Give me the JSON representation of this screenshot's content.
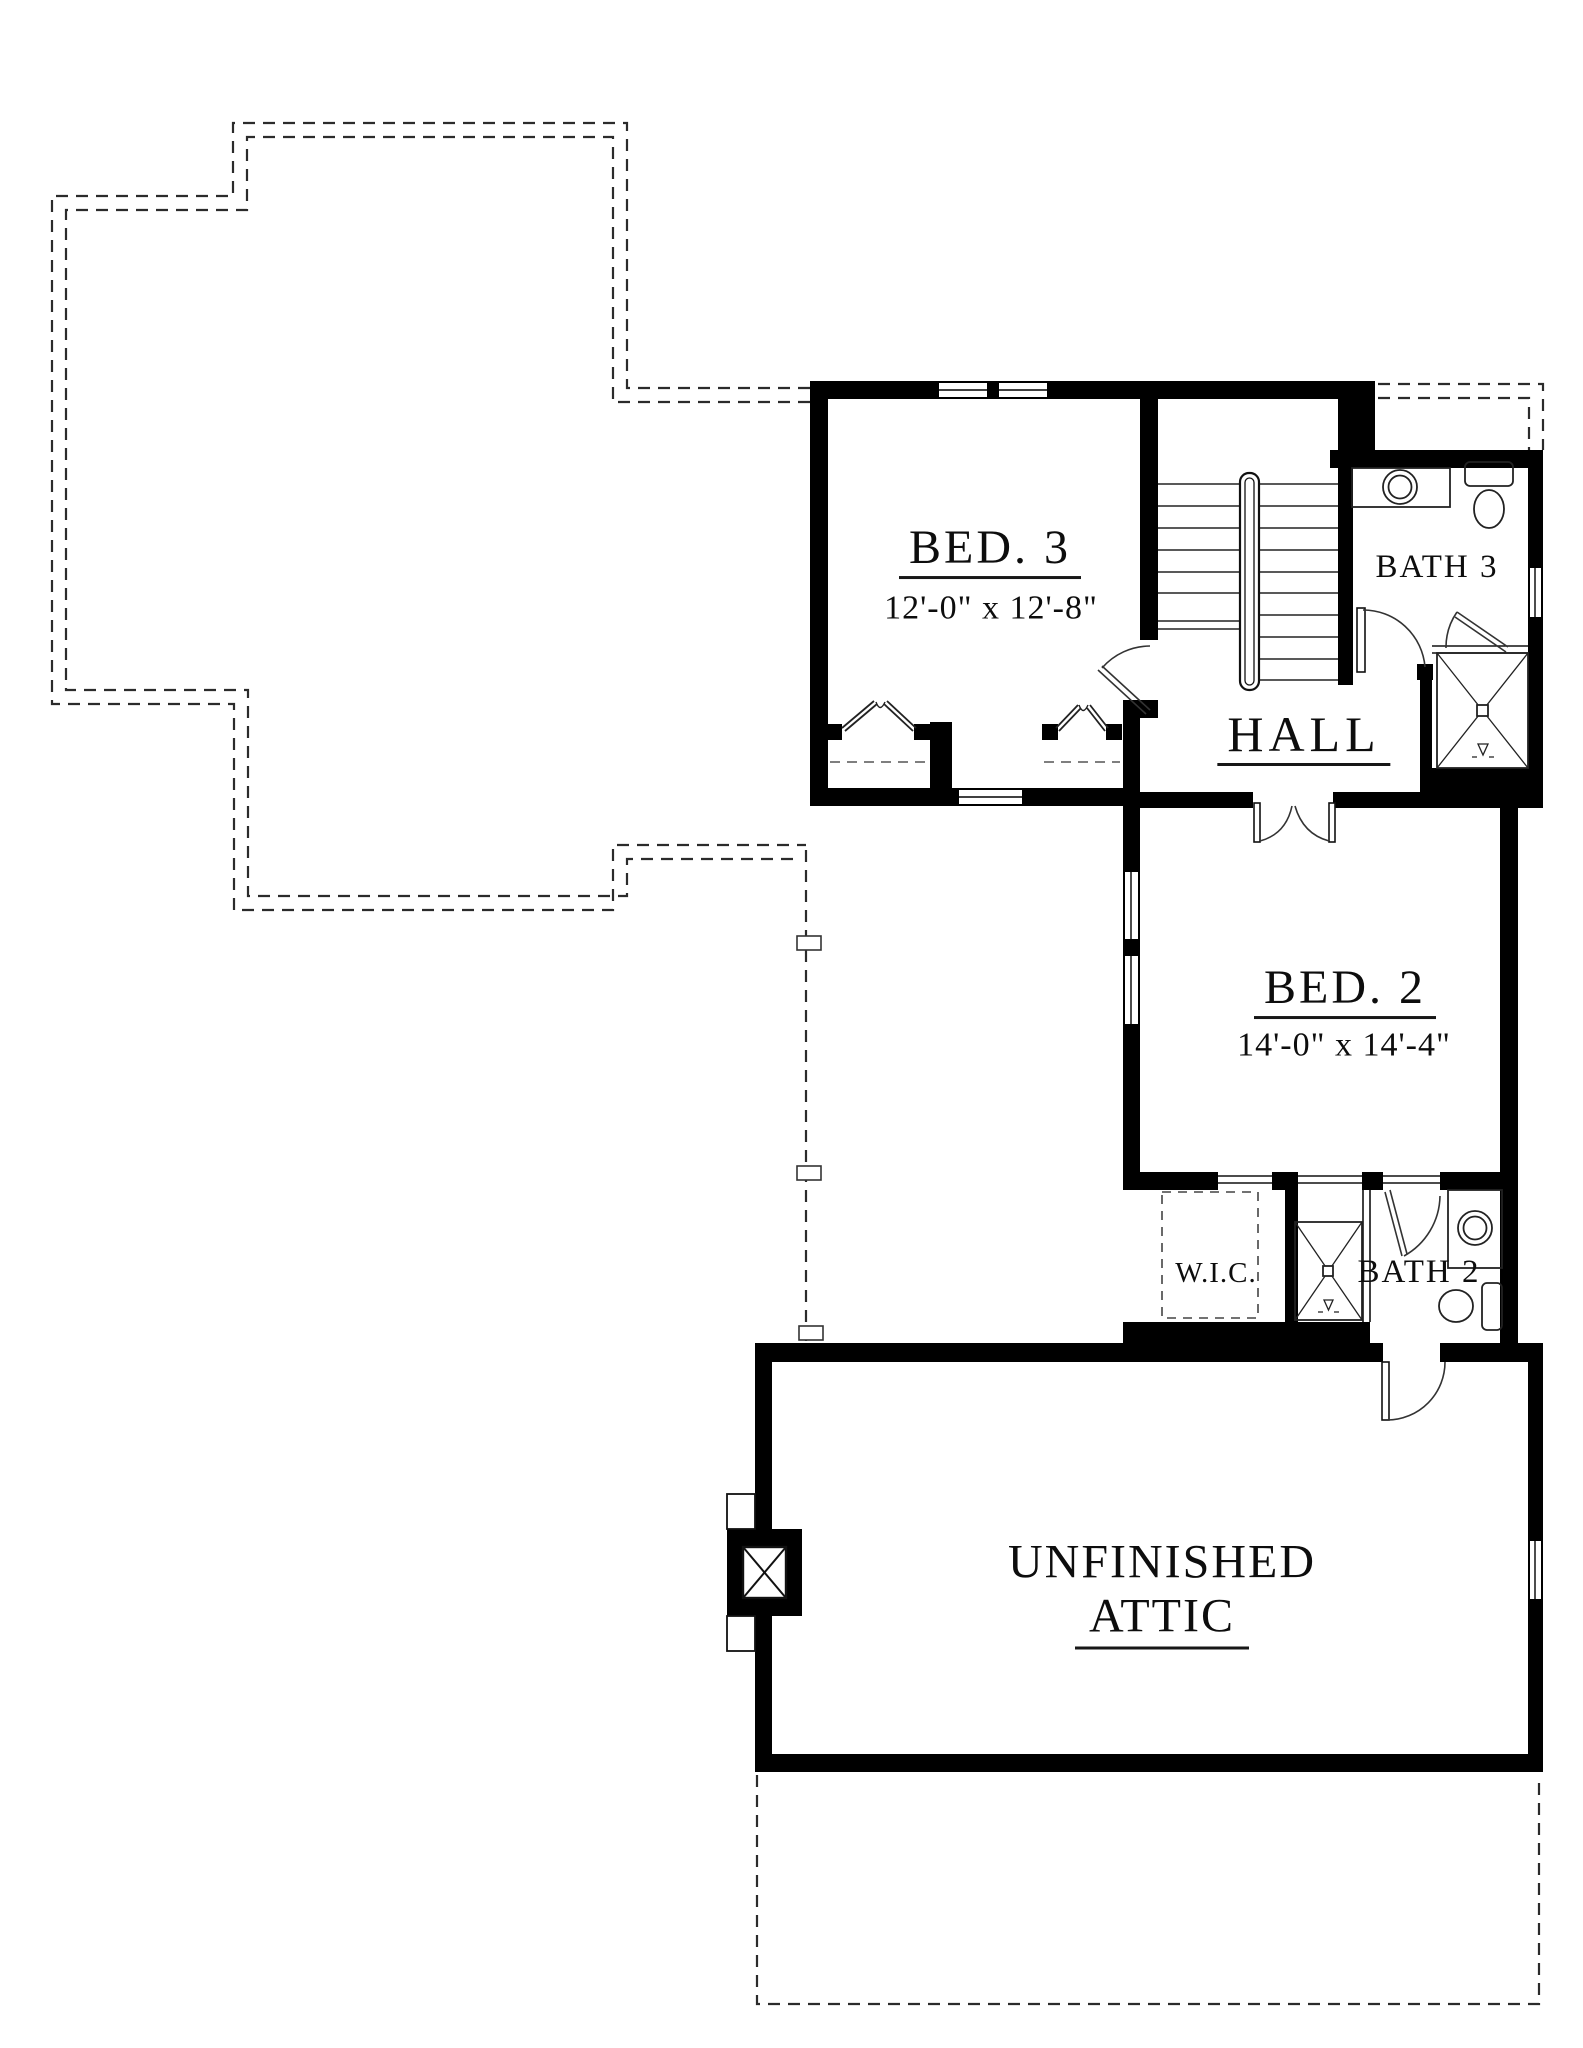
{
  "document": {
    "type": "architectural-floor-plan",
    "floor": "second-floor",
    "background": "#ffffff",
    "ink": "#0d0d0d",
    "wall_color": "#000000",
    "dash_color": "#2b2b2b"
  },
  "rooms": {
    "bed3": {
      "name": "BED. 3",
      "dims": "12'-0\" x 12'-8\""
    },
    "bath3": {
      "name": "BATH 3"
    },
    "hall": {
      "name": "HALL"
    },
    "bed2": {
      "name": "BED. 2",
      "dims": "14'-0\" x 14'-4\""
    },
    "wic": {
      "name": "W.I.C."
    },
    "bath2": {
      "name": "BATH 2"
    },
    "attic": {
      "name_line1": "UNFINISHED",
      "name_line2": "ATTIC"
    }
  },
  "symbols": [
    "stairs-with-handrail",
    "double-entry-doors",
    "hinged-doors",
    "bifold-closet-doors",
    "windows",
    "shower-with-x",
    "round-sink",
    "toilet",
    "vanity-counter",
    "chimney-box",
    "roof-outline-dashed",
    "lower-roof-outline-dashed",
    "closet-rod-dashed"
  ]
}
